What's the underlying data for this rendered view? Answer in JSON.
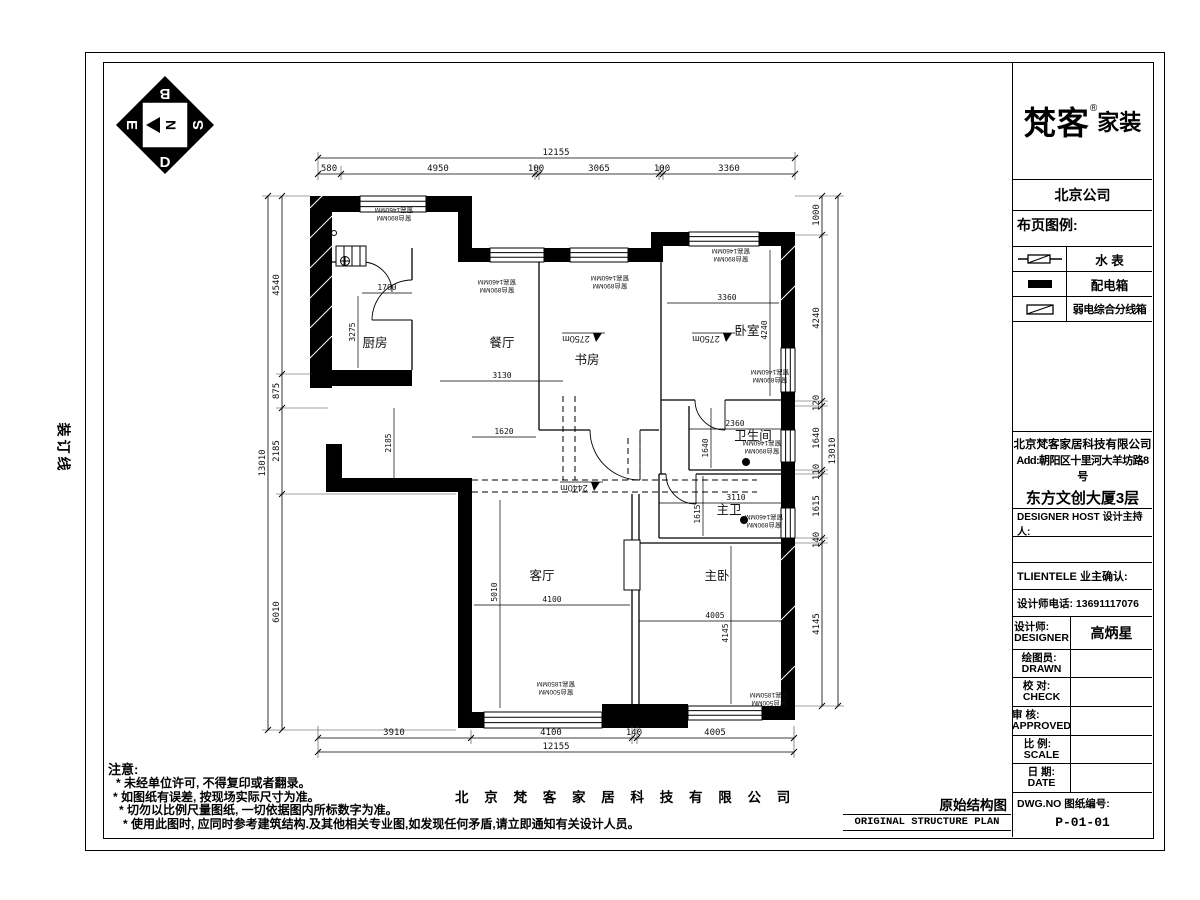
{
  "sheet": {
    "binding_line": "装订线",
    "compass": {
      "center_letter": "N",
      "top_letter": "B",
      "bottom_letter": "D",
      "left_letter": "E",
      "right_letter": "S"
    }
  },
  "brand": {
    "logo_main": "梵客",
    "logo_reg": "®",
    "logo_sub": "家装",
    "company_short": "北京公司"
  },
  "legend": {
    "title": "布页图例:",
    "items": [
      {
        "name": "水  表",
        "icon": "water-meter-icon"
      },
      {
        "name": "配电箱",
        "icon": "distribution-box-icon"
      },
      {
        "name": "弱电综合分线箱",
        "icon": "low-voltage-box-icon"
      }
    ]
  },
  "contact": {
    "company": "北京梵客家居科技有限公司",
    "address1": "Add:朝阳区十里河大羊坊路8号",
    "address2": "东方文创大厦3层",
    "tel": "Tel: 400-114-6767"
  },
  "approval": {
    "designer_host": "DESIGNER HOST 设计主持人:",
    "client_confirm": "TLIENTELE 业主确认:",
    "designer_phone": "设计师电话: 13691117076",
    "designer_cn": "设计师:",
    "designer_en": "DESIGNER",
    "designer_name": "高炳星",
    "drawn_cn": "绘图员:",
    "drawn_en": "DRAWN",
    "check_cn": "校 对:",
    "check_en": "CHECK",
    "approved_cn": "审 核:",
    "approved_en": "APPROVED",
    "scale_cn": "比 例:",
    "scale_en": "SCALE",
    "date_cn": "日 期:",
    "date_en": "DATE",
    "dwg_label": "DWG.NO 图纸编号:",
    "dwg_no": "P-01-01"
  },
  "notes": {
    "title": "注意:",
    "items": [
      "* 未经单位许可, 不得复印或者翻录。",
      "* 如图纸有误差, 按现场实际尺寸为准。",
      "* 切勿以比例尺量图纸, 一切依据图内所标数字为准。",
      "* 使用此图时, 应同时参考建筑结构.及其他相关专业图,如发现任何矛盾,请立即通知有关设计人员。"
    ]
  },
  "footer": {
    "company_spaced": "北 京 梵 客 家 居 科 技 有 限 公 司",
    "drawing_title_cn": "原始结构图",
    "drawing_title_en": "ORIGINAL  STRUCTURE  PLAN"
  },
  "plan": {
    "rooms": [
      "厨房",
      "餐厅",
      "书房",
      "卧室",
      "卫生间",
      "主卫",
      "客厅",
      "主卧"
    ],
    "heights": [
      "2750m",
      "2750m",
      "2440m"
    ],
    "window_notes": {
      "sill890": "窗台890MM",
      "h1460": "窗高1460MM",
      "sill500": "窗台500MM",
      "h1850": "窗高1850MM"
    },
    "dims": {
      "top_total": "12155",
      "top": [
        "580",
        "4950",
        "100",
        "3065",
        "100",
        "3360"
      ],
      "bottom": [
        "3910",
        "4100",
        "140",
        "4005"
      ],
      "bottom_total": "12155",
      "left": [
        "4540",
        "875",
        "2185",
        "6010"
      ],
      "left_total": "13010",
      "right": [
        "1000",
        "4240",
        "120",
        "1640",
        "110",
        "1615",
        "140",
        "4145"
      ],
      "right_total": "13010",
      "inner": [
        "1700",
        "3275",
        "3130",
        "2185",
        "1620",
        "3360",
        "4240",
        "2360",
        "1640",
        "3110",
        "1615",
        "5010",
        "4100",
        "4005",
        "4145"
      ]
    }
  }
}
